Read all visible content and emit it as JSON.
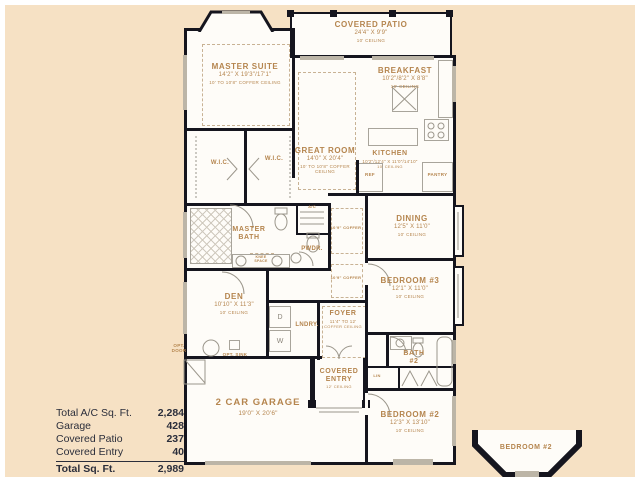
{
  "page": {
    "background": "#F6E1C4",
    "paper": "#FEFCF8",
    "wall_color": "#15151E",
    "accent_text_color": "#B5854E",
    "table_text_color": "#2B2E3B"
  },
  "rooms": {
    "covered_patio": {
      "name": "COVERED PATIO",
      "dims": "24'4\" X 9'9\"",
      "ceiling": "10' CEILING"
    },
    "master_suite": {
      "name": "MASTER SUITE",
      "dims": "14'2\" X 19'3\"/17'1\"",
      "ceiling": "10' TO 10'8\" COFFER CEILING"
    },
    "great_room": {
      "name": "GREAT ROOM",
      "dims": "14'0\" X 20'4\"",
      "ceiling": "10' TO 10'8\" COFFER CEILING"
    },
    "breakfast": {
      "name": "BREAKFAST",
      "dims": "10'2\"/8'2\" X 8'8\"",
      "ceiling": "10' CEILING"
    },
    "kitchen": {
      "name": "KITCHEN",
      "dims": "10'2\"/12'4\" X 11'0\"/14'10\"",
      "ceiling": "10' CEILING"
    },
    "dining": {
      "name": "DINING",
      "dims": "12'5\" X 11'0\"",
      "ceiling": "10' CEILING"
    },
    "bedroom_3": {
      "name": "BEDROOM #3",
      "dims": "12'1\" X 11'0\"",
      "ceiling": "10' CEILING"
    },
    "bedroom_2": {
      "name": "BEDROOM #2",
      "dims": "12'3\" X 13'10\"",
      "ceiling": "10' CEILING"
    },
    "den": {
      "name": "DEN",
      "dims": "10'10\" X 11'3\"",
      "ceiling": "10' CEILING"
    },
    "garage": {
      "name": "2 CAR GARAGE",
      "dims": "19'0\" X 20'6\""
    },
    "foyer": {
      "name": "FOYER",
      "dims": "11'4\" TO 12'",
      "ceiling": "COFFER CEILING"
    },
    "covered_entry": {
      "name": "COVERED ENTRY",
      "ceiling": "12' CEILING"
    },
    "master_bath": {
      "name": "MASTER BATH"
    },
    "bath_2": {
      "name": "BATH #2"
    }
  },
  "labels": {
    "wic_left": "W.I.C.",
    "wic_right": "W.I.C.",
    "pwdr": "PWDR.",
    "lndry": "LNDRY.",
    "dryer": "D",
    "washer": "W",
    "lin": "LIN",
    "pantry": "PANTRY",
    "ref": "REF",
    "ac": "A/C",
    "knee_space": "KNEE SPACE",
    "opt_door": "OPT. DOOR",
    "opt_sink": "OPT. SINK",
    "coffer_hall_upper": "10'9\" COFFER",
    "coffer_hall_lower": "10'9\" COFFER",
    "bay_window_detail": "BEDROOM #2"
  },
  "summary": {
    "rows": [
      {
        "label": "Total A/C Sq. Ft.",
        "value": "2,284"
      },
      {
        "label": "Garage",
        "value": "428"
      },
      {
        "label": "Covered Patio",
        "value": "237"
      },
      {
        "label": "Covered Entry",
        "value": "40"
      }
    ],
    "total": {
      "label": "Total Sq. Ft.",
      "value": "2,989"
    }
  }
}
